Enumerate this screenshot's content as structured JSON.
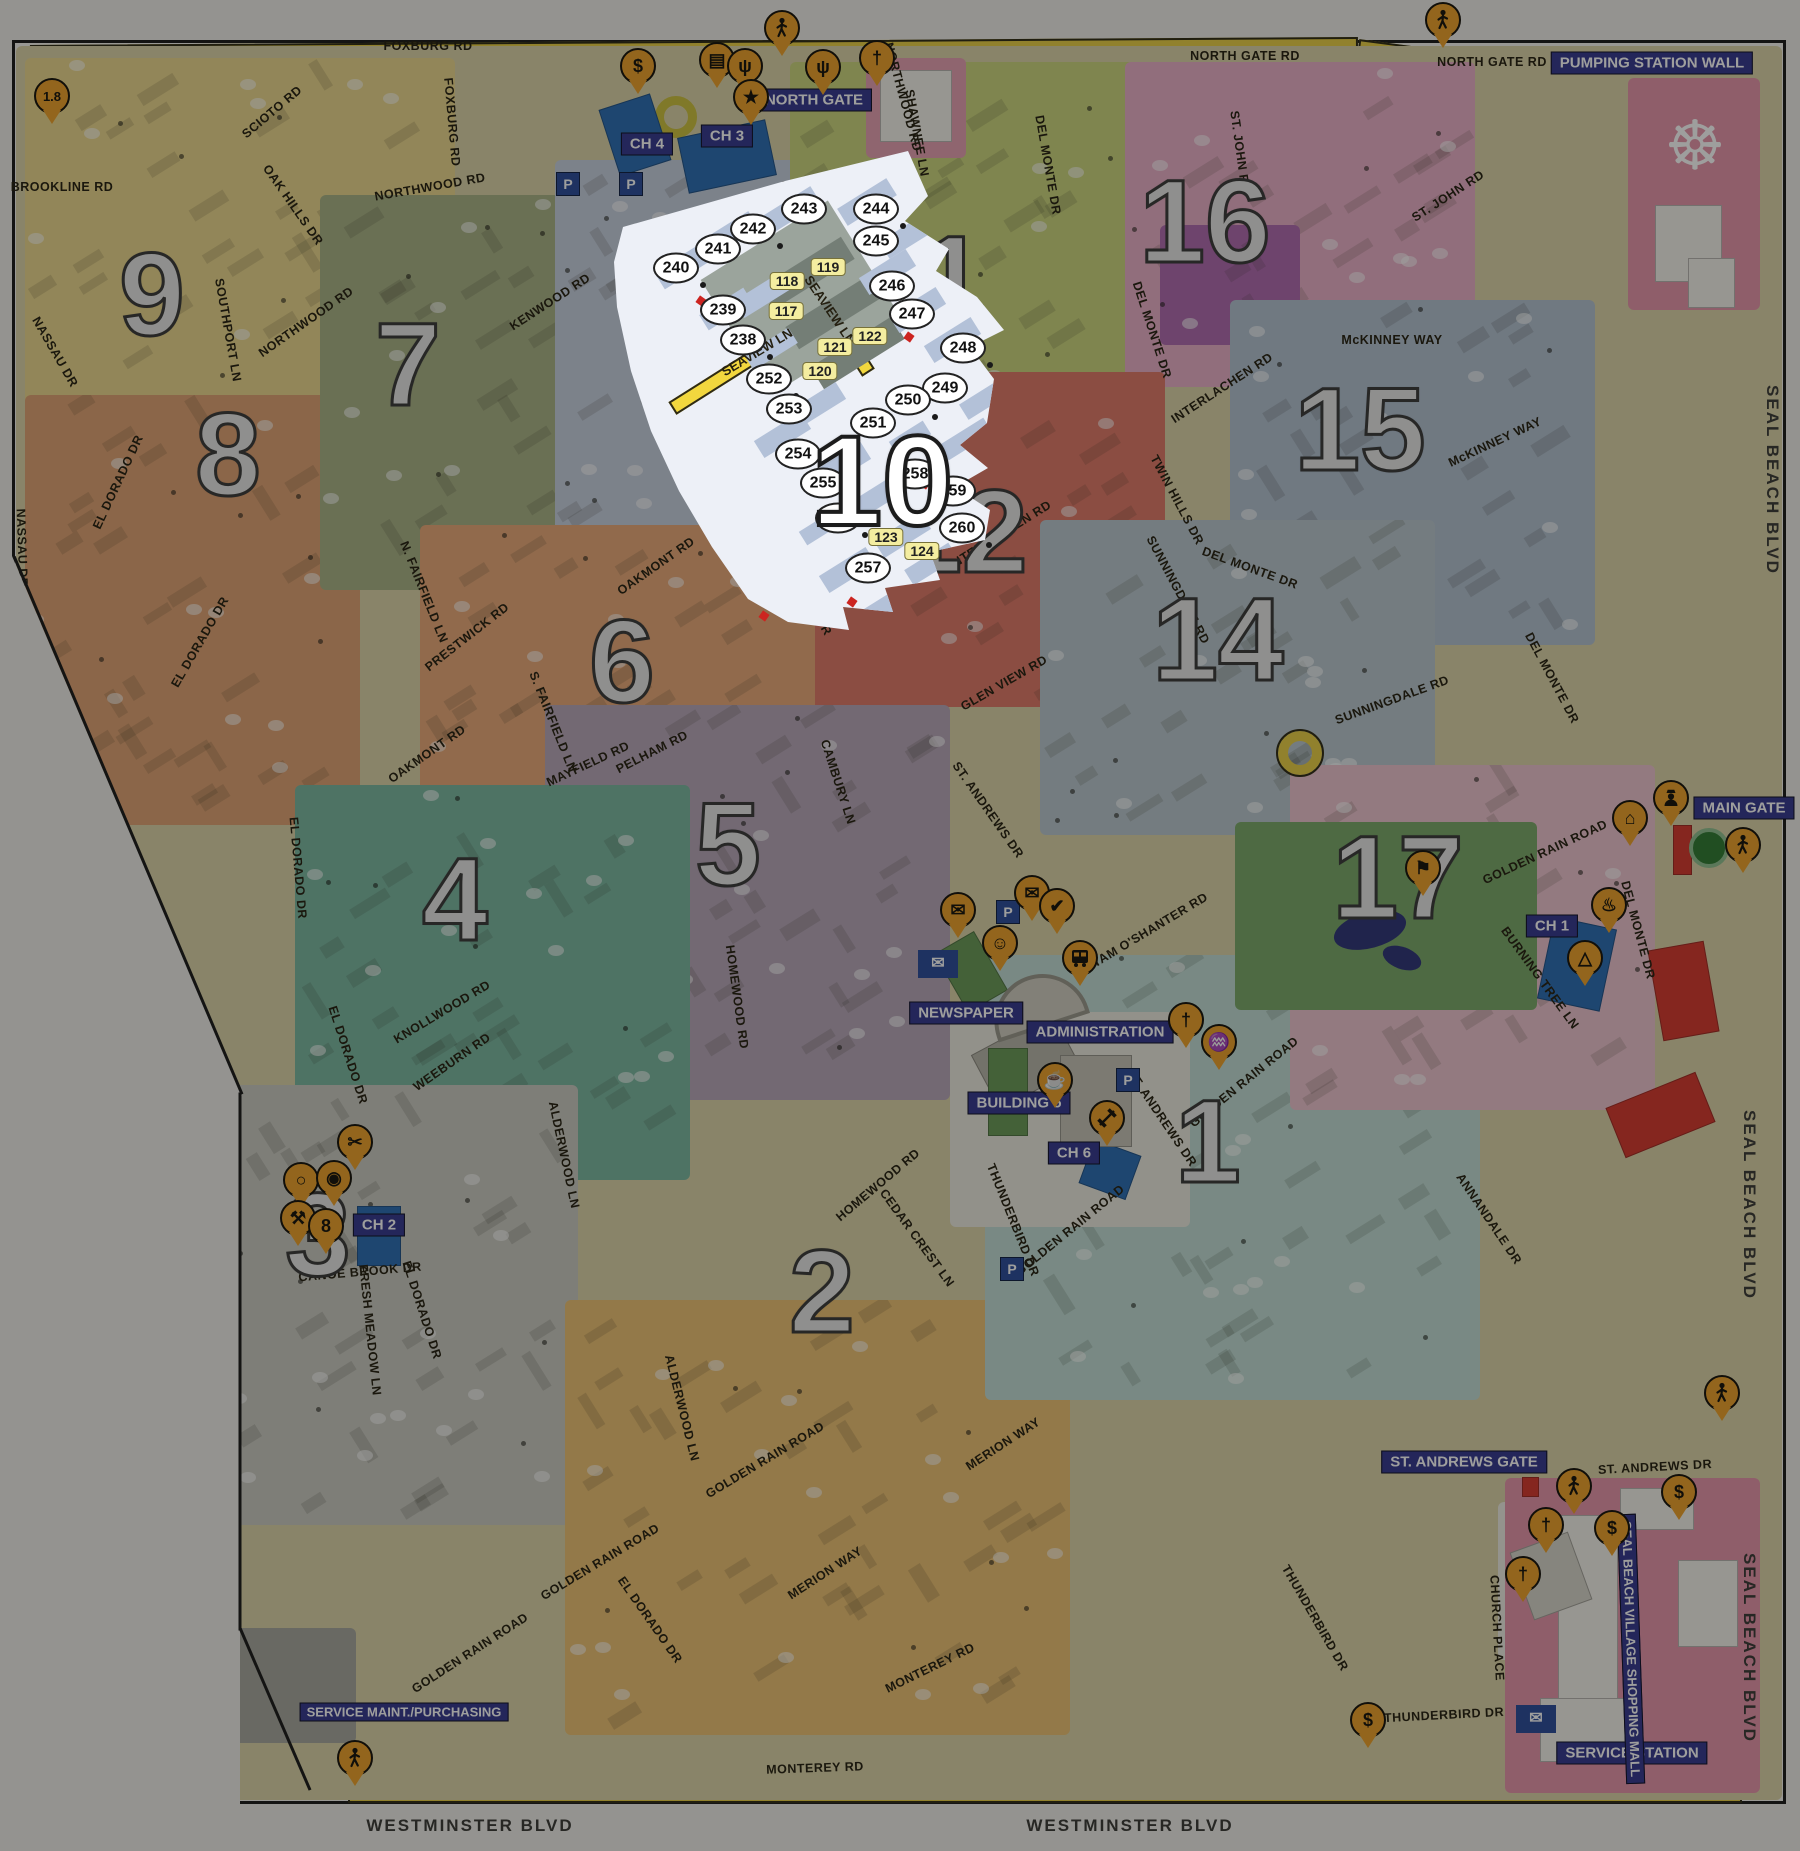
{
  "map": {
    "highlight": {
      "number": "10",
      "street_labels": [
        {
          "text": "SEAVIEW LN",
          "x": 757,
          "y": 352,
          "r": -31
        },
        {
          "text": "SEAVIEW LN",
          "x": 830,
          "y": 310,
          "r": 56
        }
      ],
      "building_circles": [
        {
          "n": "238",
          "x": 743,
          "y": 340
        },
        {
          "n": "239",
          "x": 723,
          "y": 310
        },
        {
          "n": "240",
          "x": 676,
          "y": 268
        },
        {
          "n": "241",
          "x": 718,
          "y": 249
        },
        {
          "n": "242",
          "x": 753,
          "y": 229
        },
        {
          "n": "243",
          "x": 804,
          "y": 209
        },
        {
          "n": "244",
          "x": 876,
          "y": 209
        },
        {
          "n": "245",
          "x": 876,
          "y": 241
        },
        {
          "n": "246",
          "x": 892,
          "y": 286
        },
        {
          "n": "247",
          "x": 912,
          "y": 314
        },
        {
          "n": "248",
          "x": 963,
          "y": 348
        },
        {
          "n": "249",
          "x": 945,
          "y": 388
        },
        {
          "n": "250",
          "x": 908,
          "y": 400
        },
        {
          "n": "251",
          "x": 873,
          "y": 423
        },
        {
          "n": "252",
          "x": 769,
          "y": 379
        },
        {
          "n": "253",
          "x": 789,
          "y": 409
        },
        {
          "n": "254",
          "x": 798,
          "y": 454
        },
        {
          "n": "255",
          "x": 823,
          "y": 483
        },
        {
          "n": "256",
          "x": 838,
          "y": 518
        },
        {
          "n": "257",
          "x": 868,
          "y": 568
        },
        {
          "n": "258",
          "x": 915,
          "y": 474
        },
        {
          "n": "259",
          "x": 953,
          "y": 491
        },
        {
          "n": "260",
          "x": 962,
          "y": 528
        }
      ],
      "unit_tags": [
        {
          "n": "117",
          "x": 786,
          "y": 311
        },
        {
          "n": "118",
          "x": 787,
          "y": 281
        },
        {
          "n": "119",
          "x": 828,
          "y": 267
        },
        {
          "n": "120",
          "x": 820,
          "y": 371
        },
        {
          "n": "121",
          "x": 835,
          "y": 347
        },
        {
          "n": "122",
          "x": 870,
          "y": 336
        },
        {
          "n": "123",
          "x": 886,
          "y": 537
        },
        {
          "n": "124",
          "x": 922,
          "y": 551
        }
      ]
    },
    "districts": [
      {
        "n": "9",
        "x": 152,
        "y": 295
      },
      {
        "n": "8",
        "x": 228,
        "y": 455
      },
      {
        "n": "7",
        "x": 408,
        "y": 365
      },
      {
        "n": "6",
        "x": 622,
        "y": 662
      },
      {
        "n": "5",
        "x": 728,
        "y": 845
      },
      {
        "n": "4",
        "x": 455,
        "y": 900
      },
      {
        "n": "3",
        "x": 318,
        "y": 1235
      },
      {
        "n": "2",
        "x": 822,
        "y": 1292
      },
      {
        "n": "1",
        "x": 1208,
        "y": 1142
      },
      {
        "n": "11",
        "x": 923,
        "y": 278
      },
      {
        "n": "12",
        "x": 962,
        "y": 532
      },
      {
        "n": "14",
        "x": 1218,
        "y": 640
      },
      {
        "n": "15",
        "x": 1360,
        "y": 430
      },
      {
        "n": "16",
        "x": 1205,
        "y": 222
      },
      {
        "n": "17",
        "x": 1398,
        "y": 878
      }
    ],
    "badges": [
      {
        "text": "NORTH GATE",
        "x": 814,
        "y": 100,
        "r": 0
      },
      {
        "text": "MAIN GATE",
        "x": 1744,
        "y": 808,
        "r": 0
      },
      {
        "text": "ST. ANDREWS GATE",
        "x": 1464,
        "y": 1462,
        "r": 0
      },
      {
        "text": "PUMPING STATION WALL",
        "x": 1652,
        "y": 63,
        "r": 0
      },
      {
        "text": "SERVICE MAINT./PURCHASING",
        "x": 404,
        "y": 1712,
        "r": 0
      },
      {
        "text": "SERVICE STATION",
        "x": 1632,
        "y": 1753,
        "r": 0
      },
      {
        "text": "SEAL BEACH VILLAGE SHOPPING MALL",
        "x": 1631,
        "y": 1649,
        "r": 88
      },
      {
        "text": "ADMINISTRATION",
        "x": 1100,
        "y": 1032,
        "r": 0
      },
      {
        "text": "NEWSPAPER",
        "x": 966,
        "y": 1013,
        "r": 0
      },
      {
        "text": "BUILDING 5",
        "x": 1019,
        "y": 1103,
        "r": 0
      },
      {
        "text": "CH 4",
        "x": 647,
        "y": 144,
        "r": 0
      },
      {
        "text": "CH 3",
        "x": 727,
        "y": 136,
        "r": 0
      },
      {
        "text": "CH 1",
        "x": 1552,
        "y": 926,
        "r": 0
      },
      {
        "text": "CH 6",
        "x": 1074,
        "y": 1153,
        "r": 0
      },
      {
        "text": "CH 2",
        "x": 379,
        "y": 1225,
        "r": 0
      }
    ],
    "road_labels": [
      {
        "text": "NORTH GATE RD",
        "x": 1245,
        "y": 56,
        "r": 0
      },
      {
        "text": "NORTH GATE RD",
        "x": 1492,
        "y": 62,
        "r": 0
      },
      {
        "text": "FOXBURG RD",
        "x": 428,
        "y": 46,
        "r": 0
      },
      {
        "text": "FOXBURG RD",
        "x": 452,
        "y": 122,
        "r": 85
      },
      {
        "text": "NORTHWOOD RD",
        "x": 430,
        "y": 187,
        "r": -10
      },
      {
        "text": "NORTHWOOD RD",
        "x": 838,
        "y": 182,
        "r": -4
      },
      {
        "text": "NORTHWOOD RD",
        "x": 306,
        "y": 322,
        "r": -35
      },
      {
        "text": "NORTHWOOD RD",
        "x": 903,
        "y": 97,
        "r": 75
      },
      {
        "text": "SCIOTO RD",
        "x": 272,
        "y": 112,
        "r": -40
      },
      {
        "text": "OAK HILLS DR",
        "x": 293,
        "y": 205,
        "r": 55
      },
      {
        "text": "SOUTHPORT LN",
        "x": 228,
        "y": 330,
        "r": 80
      },
      {
        "text": "BROOKLINE RD",
        "x": 62,
        "y": 187,
        "r": 0
      },
      {
        "text": "NASSAU DR",
        "x": 55,
        "y": 352,
        "r": 60
      },
      {
        "text": "NASSAU DR",
        "x": 22,
        "y": 548,
        "r": 88
      },
      {
        "text": "KENWOOD RD",
        "x": 550,
        "y": 302,
        "r": -33
      },
      {
        "text": "ST. ANDREWS DR",
        "x": 660,
        "y": 345,
        "r": 60
      },
      {
        "text": "ST. ANDREWS DR",
        "x": 800,
        "y": 585,
        "r": 60
      },
      {
        "text": "ST. ANDREWS DR",
        "x": 988,
        "y": 810,
        "r": 55
      },
      {
        "text": "ST. ANDREWS DR",
        "x": 1162,
        "y": 1118,
        "r": 56
      },
      {
        "text": "ST. ANDREWS DR",
        "x": 1655,
        "y": 1467,
        "r": -3
      },
      {
        "text": "EL DORADO DR",
        "x": 118,
        "y": 482,
        "r": -65
      },
      {
        "text": "EL DORADO DR",
        "x": 200,
        "y": 642,
        "r": -60
      },
      {
        "text": "EL DORADO DR",
        "x": 298,
        "y": 868,
        "r": 85
      },
      {
        "text": "EL DORADO DR",
        "x": 348,
        "y": 1055,
        "r": 72
      },
      {
        "text": "EL DORADO DR",
        "x": 422,
        "y": 1310,
        "r": 72
      },
      {
        "text": "EL DORADO DR",
        "x": 650,
        "y": 1620,
        "r": 55
      },
      {
        "text": "OAKMONT RD",
        "x": 427,
        "y": 754,
        "r": -35
      },
      {
        "text": "OAKMONT RD",
        "x": 656,
        "y": 566,
        "r": -35
      },
      {
        "text": "INTERLACHEN RD",
        "x": 1000,
        "y": 535,
        "r": -32
      },
      {
        "text": "INTERLACHEN RD",
        "x": 1222,
        "y": 388,
        "r": -33
      },
      {
        "text": "INTERLACHEN RD",
        "x": 872,
        "y": 468,
        "r": 62
      },
      {
        "text": "TWIN HILLS DR",
        "x": 1177,
        "y": 500,
        "r": 62
      },
      {
        "text": "DEL MONTE DR",
        "x": 1048,
        "y": 165,
        "r": 80
      },
      {
        "text": "DEL MONTE DR",
        "x": 1152,
        "y": 330,
        "r": 72
      },
      {
        "text": "DEL MONTE DR",
        "x": 1250,
        "y": 568,
        "r": 20
      },
      {
        "text": "DEL MONTE DR",
        "x": 1552,
        "y": 678,
        "r": 62
      },
      {
        "text": "DEL MONTE DR",
        "x": 1638,
        "y": 930,
        "r": 75
      },
      {
        "text": "McKINNEY WAY",
        "x": 1392,
        "y": 340,
        "r": 0
      },
      {
        "text": "McKINNEY WAY",
        "x": 1495,
        "y": 442,
        "r": -25
      },
      {
        "text": "ST. JOHN RD",
        "x": 1448,
        "y": 196,
        "r": -33
      },
      {
        "text": "ST. JOHN RD",
        "x": 1240,
        "y": 152,
        "r": 82
      },
      {
        "text": "GLEN VIEW RD",
        "x": 1004,
        "y": 683,
        "r": -30
      },
      {
        "text": "TAM O'SHANTER RD",
        "x": 1150,
        "y": 930,
        "r": -31
      },
      {
        "text": "SUNNINGDALE RD",
        "x": 1178,
        "y": 590,
        "r": 62
      },
      {
        "text": "SUNNINGDALE RD",
        "x": 1392,
        "y": 700,
        "r": -20
      },
      {
        "text": "KNOLLWOOD RD",
        "x": 442,
        "y": 1012,
        "r": -31
      },
      {
        "text": "CANOE BROOK DR",
        "x": 360,
        "y": 1272,
        "r": -5
      },
      {
        "text": "CANOE BROOK DR",
        "x": 114,
        "y": 1152,
        "r": 86
      },
      {
        "text": "FRESH MEADOW LN",
        "x": 370,
        "y": 1330,
        "r": 84
      },
      {
        "text": "ALDERWOOD LN",
        "x": 682,
        "y": 1408,
        "r": 76
      },
      {
        "text": "ALDERWOOD LN",
        "x": 564,
        "y": 1155,
        "r": 78
      },
      {
        "text": "MERION WAY",
        "x": 1003,
        "y": 1444,
        "r": -33
      },
      {
        "text": "MERION WAY",
        "x": 825,
        "y": 1573,
        "r": -33
      },
      {
        "text": "MONTEREY RD",
        "x": 815,
        "y": 1768,
        "r": -2
      },
      {
        "text": "MONTEREY RD",
        "x": 930,
        "y": 1668,
        "r": -26
      },
      {
        "text": "HOMEWOOD RD",
        "x": 737,
        "y": 997,
        "r": 82
      },
      {
        "text": "HOMEWOOD RD",
        "x": 878,
        "y": 1185,
        "r": -40
      },
      {
        "text": "CEDAR CREST LN",
        "x": 917,
        "y": 1238,
        "r": 54
      },
      {
        "text": "PELHAM RD",
        "x": 652,
        "y": 752,
        "r": -27
      },
      {
        "text": "N. FAIRFIELD LN",
        "x": 424,
        "y": 592,
        "r": 68
      },
      {
        "text": "S. FAIRFIELD LN",
        "x": 553,
        "y": 722,
        "r": 68
      },
      {
        "text": "PRESTWICK RD",
        "x": 467,
        "y": 637,
        "r": -38
      },
      {
        "text": "MAYFIELD RD",
        "x": 588,
        "y": 764,
        "r": -25
      },
      {
        "text": "BURNING TREE LN",
        "x": 1540,
        "y": 978,
        "r": 54
      },
      {
        "text": "ANNANDALE DR",
        "x": 1489,
        "y": 1219,
        "r": 56
      },
      {
        "text": "CHURCH PLACE",
        "x": 1497,
        "y": 1628,
        "r": 87
      },
      {
        "text": "THUNDERBIRD DR",
        "x": 1013,
        "y": 1220,
        "r": 68
      },
      {
        "text": "THUNDERBIRD DR",
        "x": 1315,
        "y": 1618,
        "r": 60
      },
      {
        "text": "THUNDERBIRD DR",
        "x": 1444,
        "y": 1715,
        "r": -3
      },
      {
        "text": "SHAWNEE LN",
        "x": 917,
        "y": 133,
        "r": 80
      },
      {
        "text": "GOLDEN RAIN ROAD",
        "x": 1545,
        "y": 852,
        "r": -25
      },
      {
        "text": "GOLDEN RAIN ROAD",
        "x": 1244,
        "y": 1082,
        "r": -39
      },
      {
        "text": "GOLDEN RAIN ROAD",
        "x": 1070,
        "y": 1230,
        "r": -39
      },
      {
        "text": "GOLDEN RAIN ROAD",
        "x": 765,
        "y": 1460,
        "r": -31
      },
      {
        "text": "GOLDEN RAIN ROAD",
        "x": 600,
        "y": 1562,
        "r": -31
      },
      {
        "text": "GOLDEN RAIN ROAD",
        "x": 470,
        "y": 1653,
        "r": -33
      },
      {
        "text": "GOLDEN RAIN ROAD",
        "x": 168,
        "y": 1425,
        "r": 55
      },
      {
        "text": "WEEBURN RD",
        "x": 452,
        "y": 1062,
        "r": -35
      },
      {
        "text": "CAMBURY LN",
        "x": 838,
        "y": 782,
        "r": 72
      }
    ],
    "edge_labels": [
      {
        "text": "WESTMINSTER BLVD",
        "x": 470,
        "y": 1826,
        "r": 0
      },
      {
        "text": "WESTMINSTER BLVD",
        "x": 1130,
        "y": 1826,
        "r": 0
      },
      {
        "text": "SEAL BEACH BLVD",
        "x": 1772,
        "y": 480,
        "r": 90
      },
      {
        "text": "SEAL BEACH BLVD",
        "x": 1749,
        "y": 1205,
        "r": 90
      },
      {
        "text": "SEAL BEACH BLVD",
        "x": 1749,
        "y": 1648,
        "r": 90
      }
    ],
    "pins": [
      {
        "name": "fare-1-8-pin",
        "glyph": "1.8",
        "x": 52,
        "y": 96,
        "small": true
      },
      {
        "name": "dollar-sign-pin",
        "glyph": "$",
        "x": 638,
        "y": 66
      },
      {
        "name": "library-pin",
        "glyph": "▤",
        "x": 717,
        "y": 60
      },
      {
        "name": "broadcast-antenna-pin",
        "glyph": "ψ",
        "x": 745,
        "y": 66
      },
      {
        "name": "star-pin",
        "glyph": "★",
        "x": 751,
        "y": 97
      },
      {
        "name": "pedestrian-gate-pin",
        "glyph": "",
        "svg": "person",
        "x": 782,
        "y": 28
      },
      {
        "name": "broadcast-antenna-pin",
        "glyph": "ψ",
        "x": 823,
        "y": 67
      },
      {
        "name": "church-pin",
        "glyph": "†",
        "x": 877,
        "y": 58
      },
      {
        "name": "pedestrian-gate-pin",
        "glyph": "",
        "svg": "person",
        "x": 1443,
        "y": 20
      },
      {
        "name": "golf-course-pin",
        "glyph": "⚑",
        "x": 1423,
        "y": 868
      },
      {
        "name": "clubhouse-pin",
        "glyph": "⌂",
        "x": 1630,
        "y": 818
      },
      {
        "name": "security-officer-pin",
        "glyph": "",
        "svg": "officer",
        "x": 1671,
        "y": 798
      },
      {
        "name": "pedestrian-gate-pin",
        "glyph": "",
        "svg": "person",
        "x": 1743,
        "y": 845
      },
      {
        "name": "barbecue-pin",
        "glyph": "♨",
        "x": 1609,
        "y": 905
      },
      {
        "name": "pyramid-pin",
        "glyph": "△",
        "x": 1585,
        "y": 958
      },
      {
        "name": "mailroom-pin",
        "glyph": "✉",
        "x": 958,
        "y": 910
      },
      {
        "name": "mailroom-pin",
        "glyph": "✉",
        "x": 1032,
        "y": 893
      },
      {
        "name": "check-pin",
        "glyph": "✔",
        "x": 1057,
        "y": 906
      },
      {
        "name": "theater-masks-pin",
        "glyph": "☺",
        "x": 1000,
        "y": 943
      },
      {
        "name": "bus-terminal-pin",
        "glyph": "",
        "svg": "bus",
        "x": 1080,
        "y": 958
      },
      {
        "name": "coffee-shop-pin",
        "glyph": "☕",
        "x": 1055,
        "y": 1080
      },
      {
        "name": "fitness-center-pin",
        "glyph": "",
        "svg": "dumbbell",
        "x": 1107,
        "y": 1118
      },
      {
        "name": "church-pin",
        "glyph": "†",
        "x": 1186,
        "y": 1020
      },
      {
        "name": "swimming-pool-pin",
        "glyph": "♒",
        "x": 1219,
        "y": 1042
      },
      {
        "name": "sewing-room-pin",
        "glyph": "✂",
        "x": 355,
        "y": 1142
      },
      {
        "name": "paddle-court-pin",
        "glyph": "○",
        "x": 301,
        "y": 1180
      },
      {
        "name": "basketball-court-pin",
        "glyph": "◉",
        "x": 334,
        "y": 1178
      },
      {
        "name": "woodshop-pin",
        "glyph": "⚒",
        "x": 298,
        "y": 1218
      },
      {
        "name": "billiards-pin",
        "glyph": "8",
        "x": 326,
        "y": 1226
      },
      {
        "name": "pedestrian-gate-pin",
        "glyph": "",
        "svg": "person",
        "x": 355,
        "y": 1758
      },
      {
        "name": "pedestrian-gate-pin",
        "glyph": "",
        "svg": "person",
        "x": 1574,
        "y": 1486
      },
      {
        "name": "church-pin",
        "glyph": "†",
        "x": 1546,
        "y": 1525
      },
      {
        "name": "church-pin",
        "glyph": "†",
        "x": 1523,
        "y": 1574
      },
      {
        "name": "dollar-sign-pin",
        "glyph": "$",
        "x": 1612,
        "y": 1528
      },
      {
        "name": "dollar-sign-pin",
        "glyph": "$",
        "x": 1679,
        "y": 1492
      },
      {
        "name": "pedestrian-gate-pin",
        "glyph": "",
        "svg": "person",
        "x": 1722,
        "y": 1393
      },
      {
        "name": "dollar-sign-pin",
        "glyph": "$",
        "x": 1368,
        "y": 1720
      }
    ],
    "parking": [
      {
        "label": "P",
        "x": 567,
        "y": 183
      },
      {
        "label": "P",
        "x": 630,
        "y": 183
      },
      {
        "label": "P",
        "x": 1007,
        "y": 911
      },
      {
        "label": "P",
        "x": 1127,
        "y": 1079
      },
      {
        "label": "P",
        "x": 1011,
        "y": 1268
      }
    ]
  }
}
